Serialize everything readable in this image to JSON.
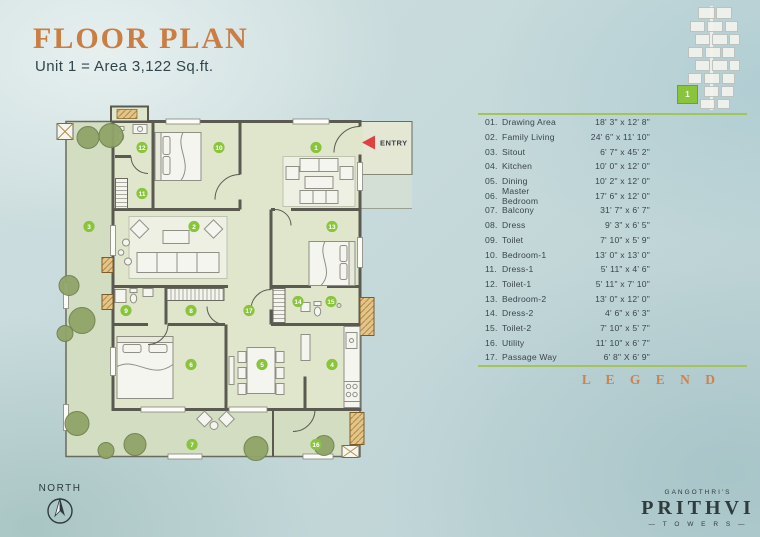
{
  "header": {
    "title": "FLOOR PLAN",
    "subtitle": "Unit 1 = Area 3,122 Sq.ft."
  },
  "plan": {
    "entry_label": "ENTRY"
  },
  "site_key": {
    "unit_number": "1"
  },
  "legend": {
    "title": "L E G E N D",
    "items": [
      {
        "no": "01.",
        "badge": "1",
        "name": "Drawing Area",
        "dim": "18' 3\" x 12' 8\""
      },
      {
        "no": "02.",
        "badge": "2",
        "name": "Family Living",
        "dim": "24' 6\" x 11' 10\""
      },
      {
        "no": "03.",
        "badge": "3",
        "name": "Sitout",
        "dim": "6' 7\" x 45' 2\""
      },
      {
        "no": "04.",
        "badge": "4",
        "name": "Kitchen",
        "dim": "10' 0\" x 12' 0\""
      },
      {
        "no": "05.",
        "badge": "5",
        "name": "Dining",
        "dim": "10' 2\" x 12' 0\""
      },
      {
        "no": "06.",
        "badge": "6",
        "name": "Master Bedroom",
        "dim": "17' 6\" x 12' 0\""
      },
      {
        "no": "07.",
        "badge": "7",
        "name": "Balcony",
        "dim": "31' 7\" x 6' 7\""
      },
      {
        "no": "08.",
        "badge": "8",
        "name": "Dress",
        "dim": "9' 3\" x 6' 5\""
      },
      {
        "no": "09.",
        "badge": "9",
        "name": "Toilet",
        "dim": "7' 10\" x 5' 9\""
      },
      {
        "no": "10.",
        "badge": "10",
        "name": "Bedroom-1",
        "dim": "13' 0\" x 13' 0\""
      },
      {
        "no": "11.",
        "badge": "11",
        "name": "Dress-1",
        "dim": "5' 11\" x 4' 6\""
      },
      {
        "no": "12.",
        "badge": "12",
        "name": "Toilet-1",
        "dim": "5' 11\" x 7' 10\""
      },
      {
        "no": "13.",
        "badge": "13",
        "name": "Bedroom-2",
        "dim": "13' 0\" x 12' 0\""
      },
      {
        "no": "14.",
        "badge": "14",
        "name": "Dress-2",
        "dim": "4' 6\" x 6' 3\""
      },
      {
        "no": "15.",
        "badge": "15",
        "name": "Toilet-2",
        "dim": "7' 10\" x 5' 7\""
      },
      {
        "no": "16.",
        "badge": "16",
        "name": "Utility",
        "dim": "11' 10\" x 6' 7\""
      },
      {
        "no": "17.",
        "badge": "17",
        "name": "Passage Way",
        "dim": "6' 8\" X 6' 9\""
      }
    ]
  },
  "north": {
    "label": "NORTH"
  },
  "brand": {
    "prefix": "GANGOTHRI'S",
    "name": "PRITHVI",
    "suffix": "— T O W E R S —"
  },
  "colors": {
    "accent_orange": "#ca7e43",
    "badge_green": "#8ac43d",
    "legend_rule_green": "#a3c45a",
    "entry_red": "#e04040",
    "wall_gray": "#5a5a50",
    "room_fill": "#e0e6cc",
    "outer_fill": "#d3ddc1",
    "brand_dark": "#2f3b3d"
  }
}
